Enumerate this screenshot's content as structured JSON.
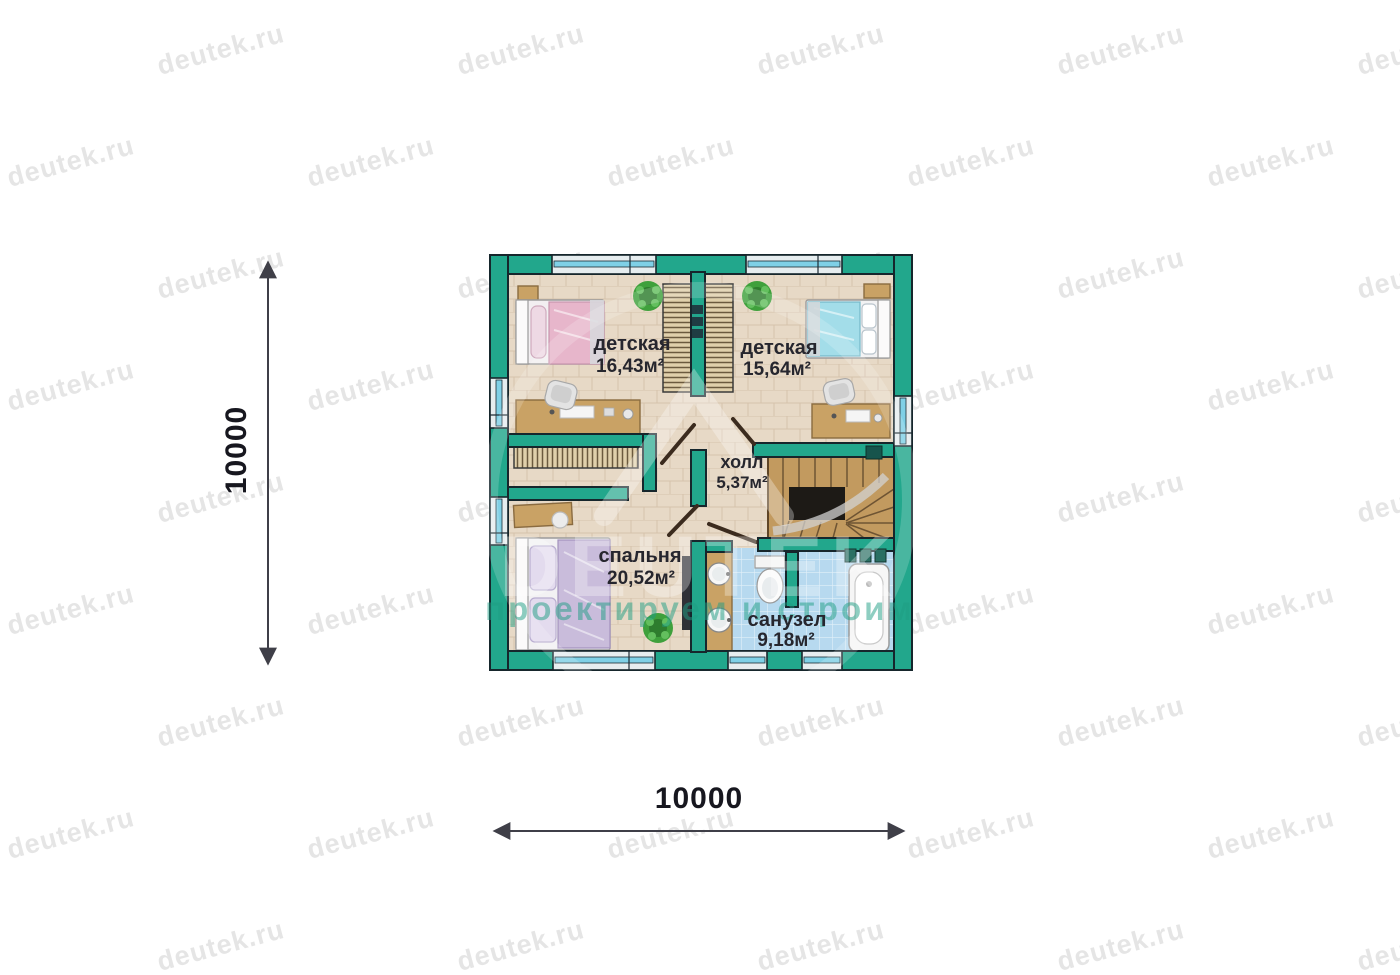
{
  "watermark": {
    "tile_text": "deutek.ru",
    "logo_text": "DEUTEK",
    "logo_tagline": "проектируем и строим"
  },
  "dimensions": {
    "vertical_label": "10000",
    "horizontal_label": "10000"
  },
  "rooms": {
    "kids_room_left": {
      "name": "детская",
      "area": "16,43м²"
    },
    "kids_room_right": {
      "name": "детская",
      "area": "15,64м²"
    },
    "hall": {
      "name": "холл",
      "area": "5,37м²"
    },
    "bedroom": {
      "name": "спальня",
      "area": "20,52м²"
    },
    "bathroom": {
      "name": "санузел",
      "area": "9,18м²"
    }
  },
  "colors": {
    "wall": "#22a78c",
    "wall_outline": "#16262c",
    "floor": "#e7d9c6",
    "bath_tile": "#b7d9ef",
    "window_glass": "#e6edef",
    "window_stripe": "#7fd0e6",
    "wood": "#c9a265",
    "stair_wood": "#c29a5f",
    "ink": "#26262e",
    "dim": "#3f3f48",
    "watermark_gray": "#c2c2c2",
    "logo_green": "#1f9e84",
    "plant": "#3fa03c",
    "bed_pink": "#e7b6cb",
    "bed_blue": "#a3dde9",
    "bed_purple": "#c9bcdb"
  }
}
